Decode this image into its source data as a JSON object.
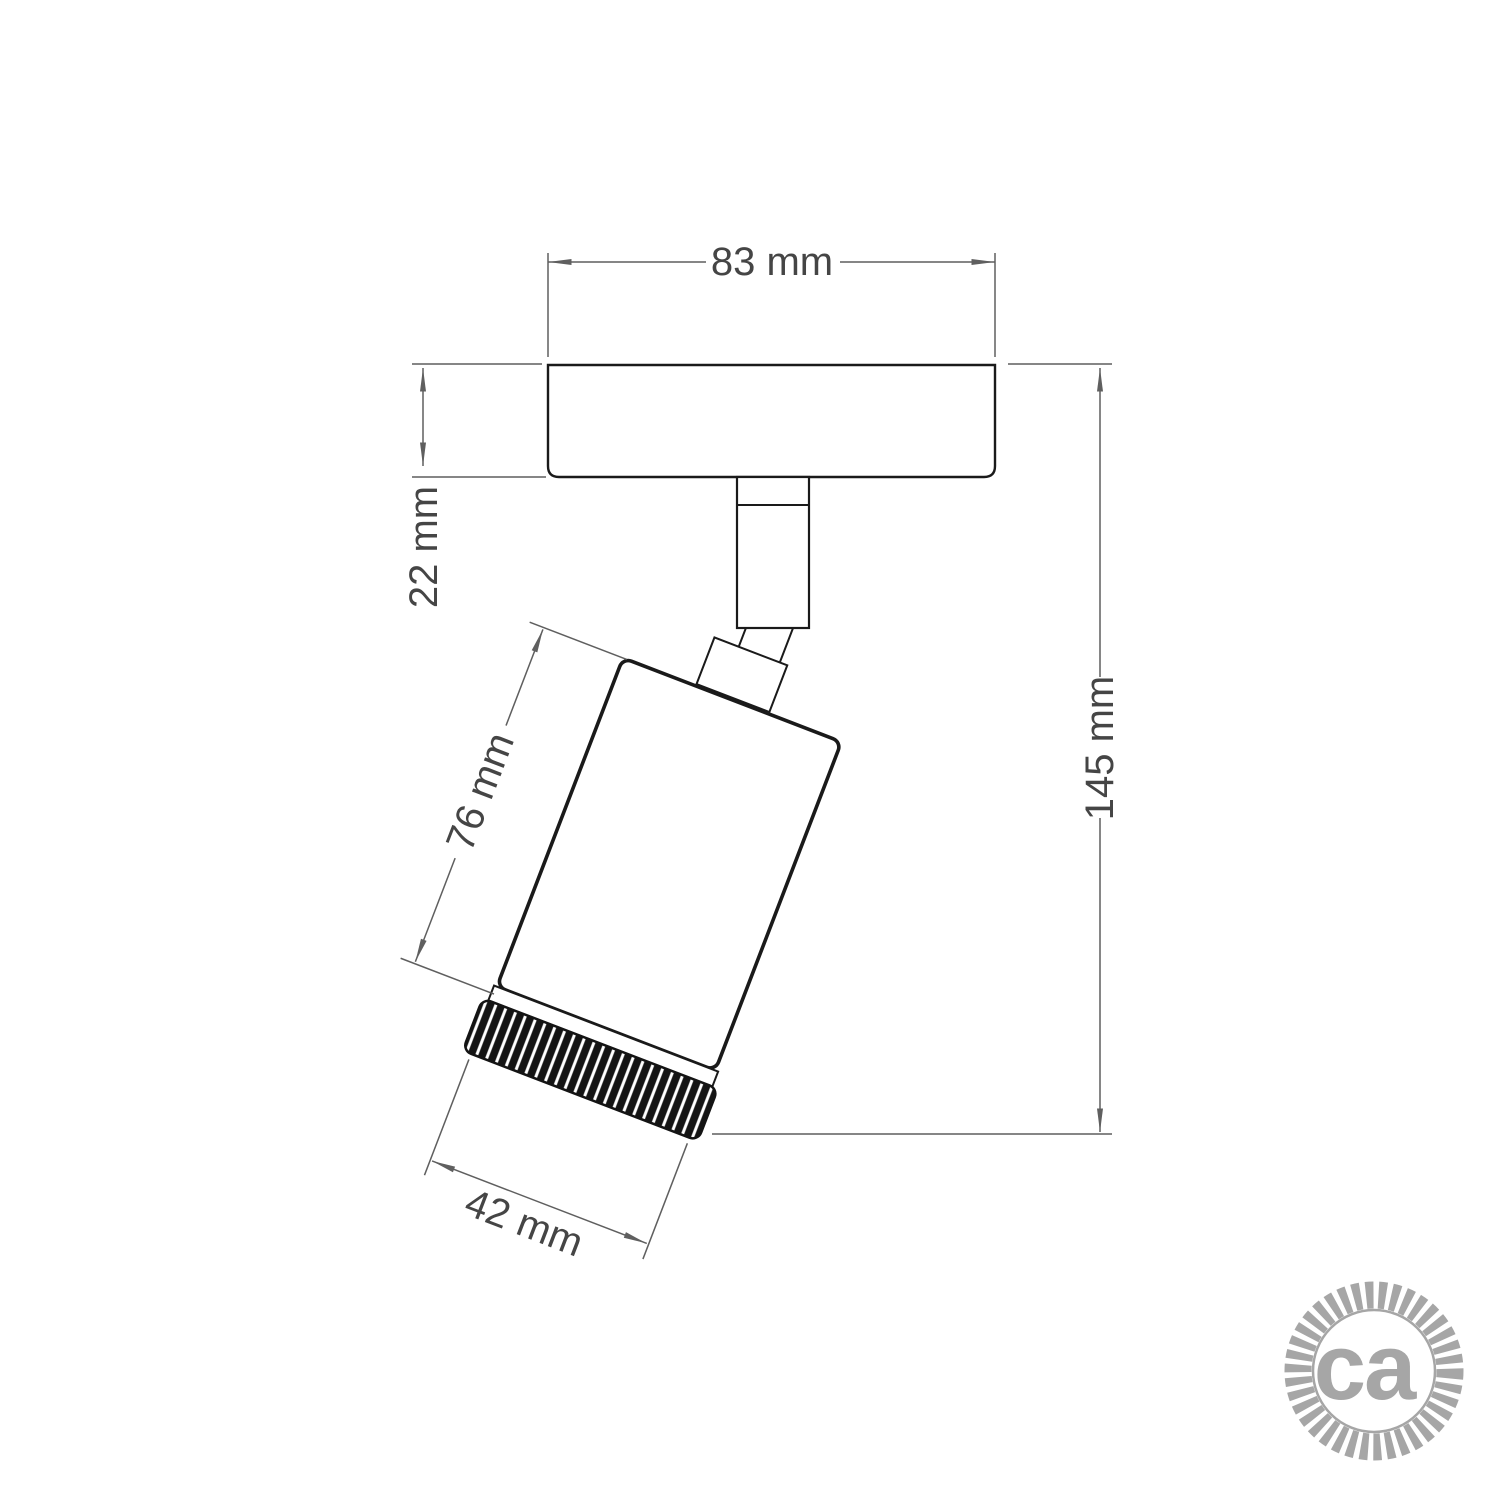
{
  "drawing": {
    "dimensions": {
      "plate_width": "83 mm",
      "plate_thickness": "22 mm",
      "overall_height": "145 mm",
      "body_length": "76 mm",
      "body_diameter": "42 mm"
    },
    "logo": {
      "text": "ca"
    },
    "colors": {
      "outline": "#1a1a1a",
      "dimension_line": "#5f5f5f",
      "dimension_text": "#454545",
      "logo_gray": "#a6a6a6",
      "background": "#ffffff"
    }
  }
}
